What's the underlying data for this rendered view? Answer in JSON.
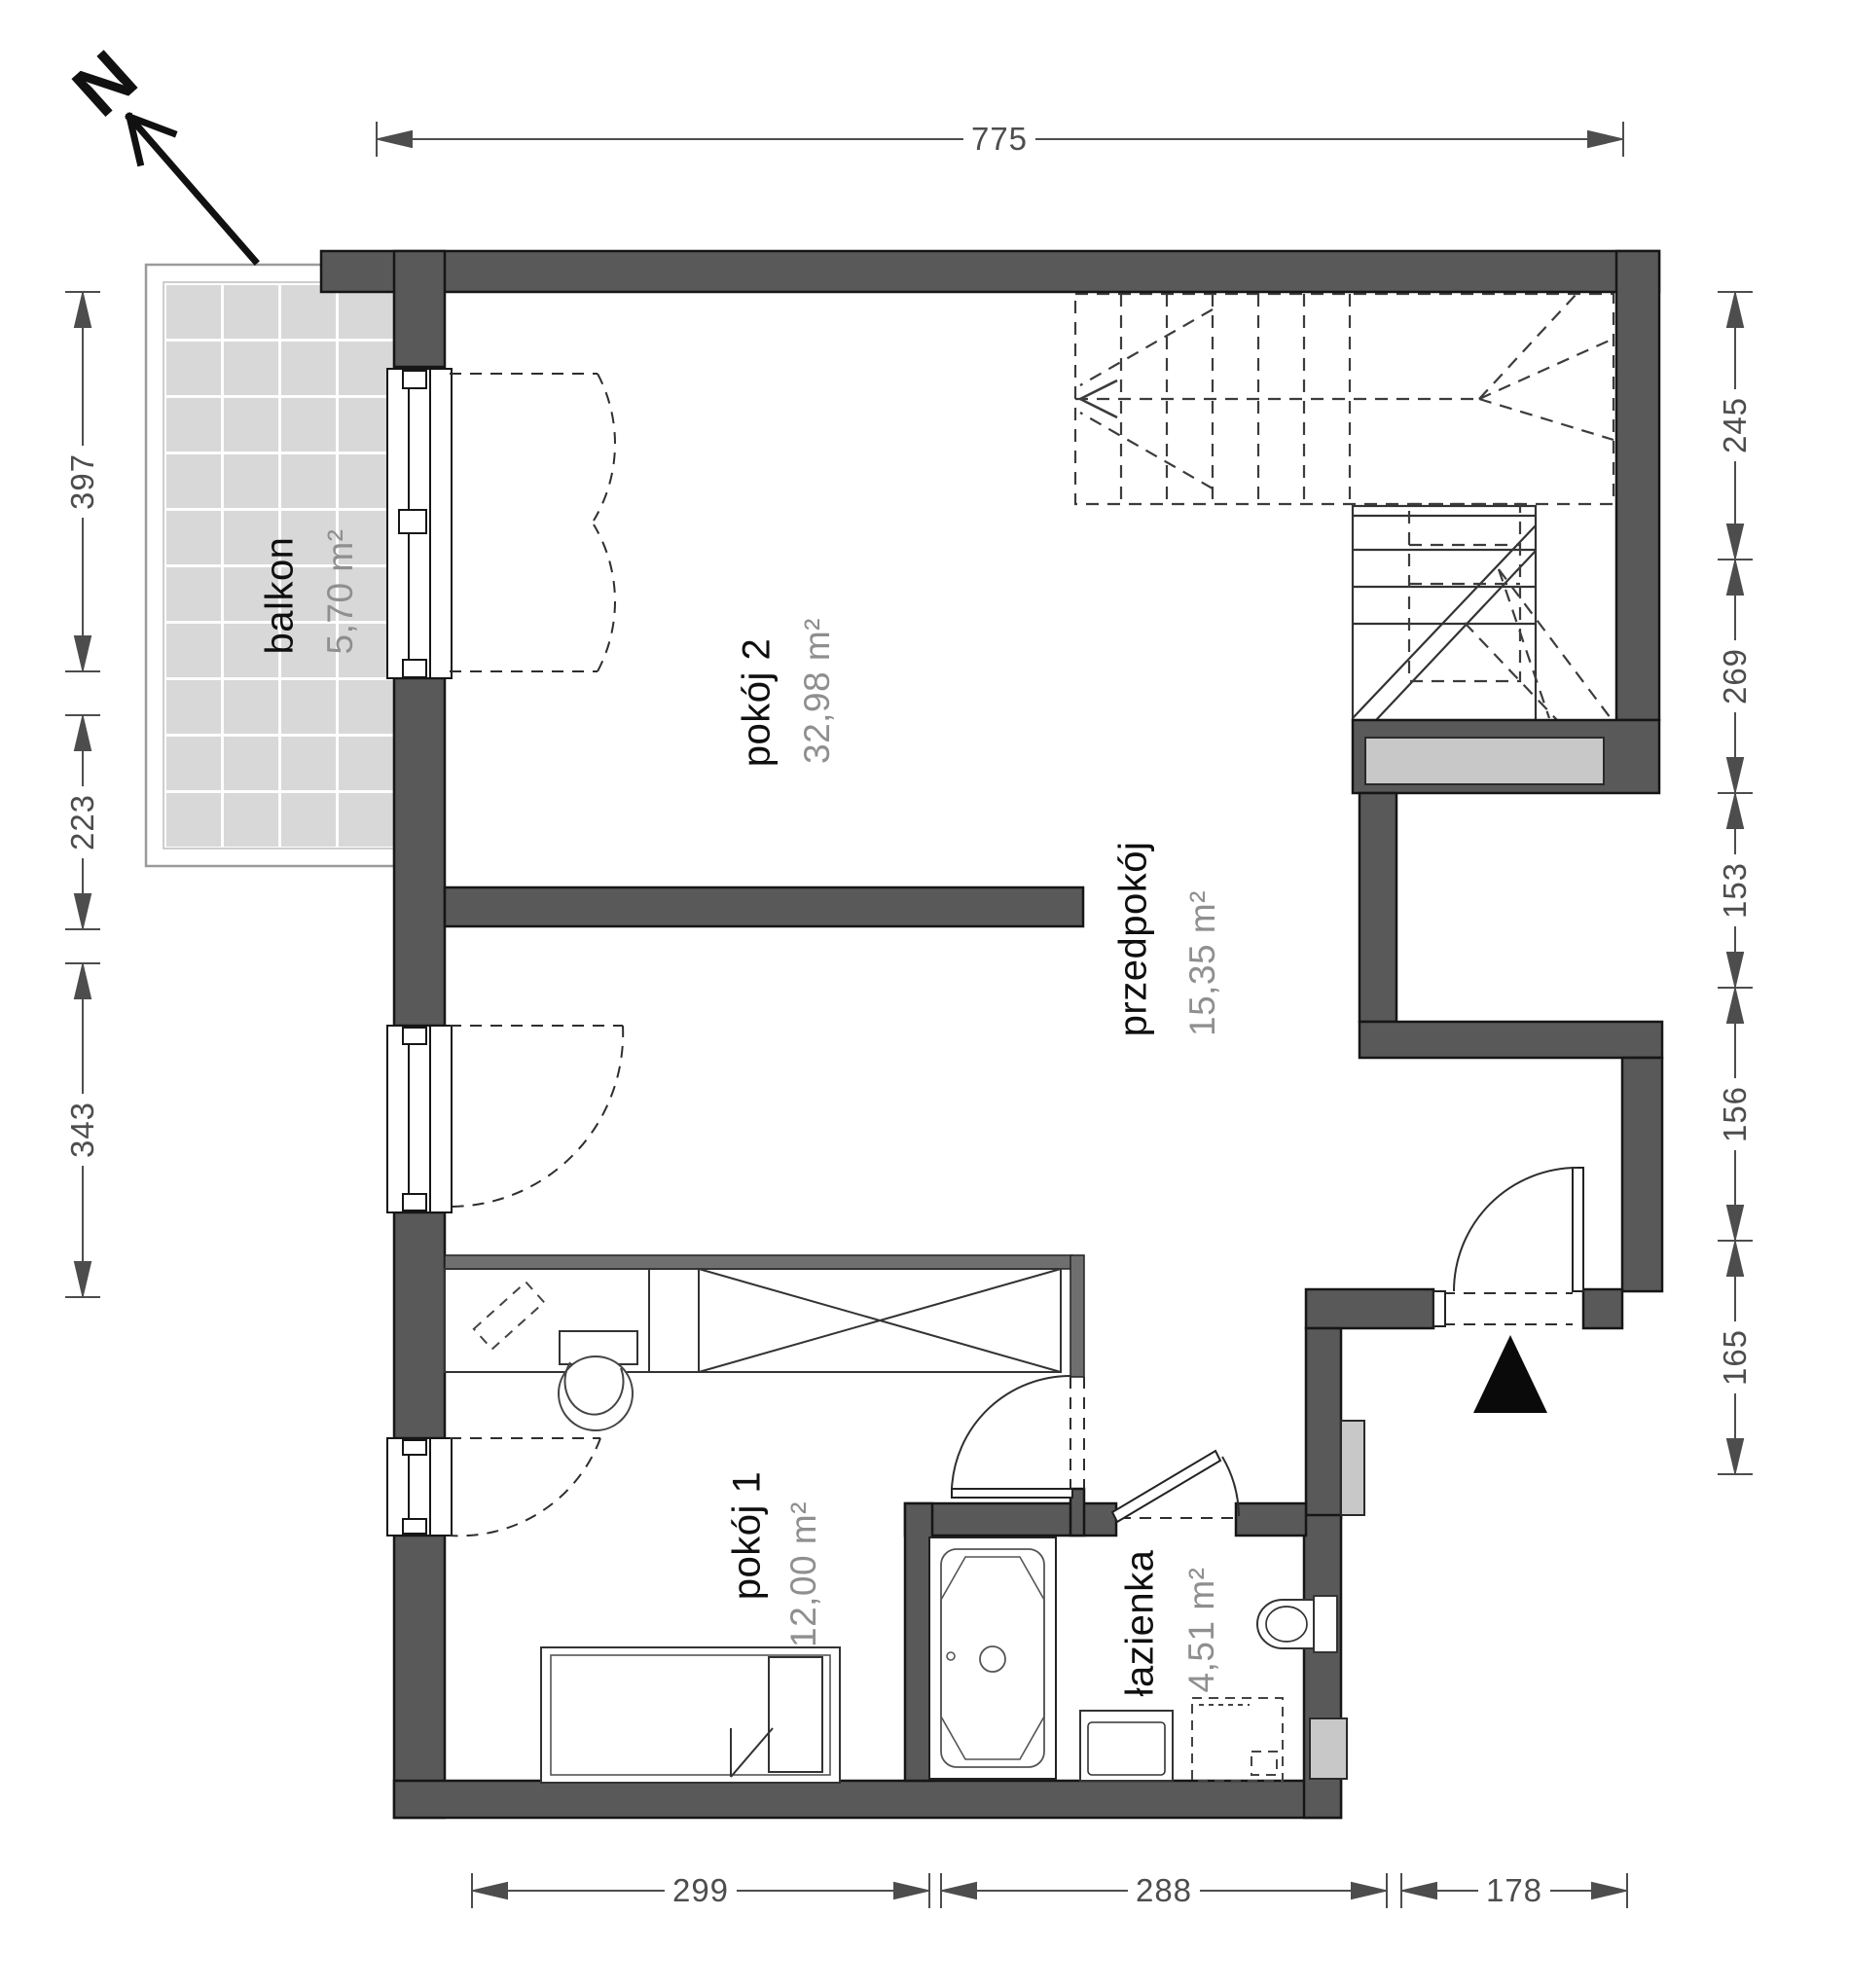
{
  "north": {
    "label": "N"
  },
  "rooms": {
    "balkon": {
      "name": "balkon",
      "area": "5,70 m²"
    },
    "pokoj2": {
      "name": "pokój 2",
      "area": "32,98 m²"
    },
    "przedpokoj": {
      "name": "przedpokój",
      "area": "15,35 m²"
    },
    "pokoj1": {
      "name": "pokój 1",
      "area": "12,00 m²"
    },
    "lazienka": {
      "name": "łazienka",
      "area": "4,51 m²"
    }
  },
  "dimensions": {
    "top": [
      "775"
    ],
    "left": [
      "397",
      "223",
      "343"
    ],
    "right": [
      "245",
      "269",
      "153",
      "156",
      "165"
    ],
    "bottom": [
      "299",
      "288",
      "178"
    ]
  },
  "colors": {
    "wall": "#595959",
    "panel": "#c8c8c8",
    "tile": "#d8d8d8",
    "dimension": "#4d4d4d",
    "room_name": "#0f0f0f",
    "room_area": "#8f8f8f",
    "entrance_marker": "#0a0a0a"
  }
}
